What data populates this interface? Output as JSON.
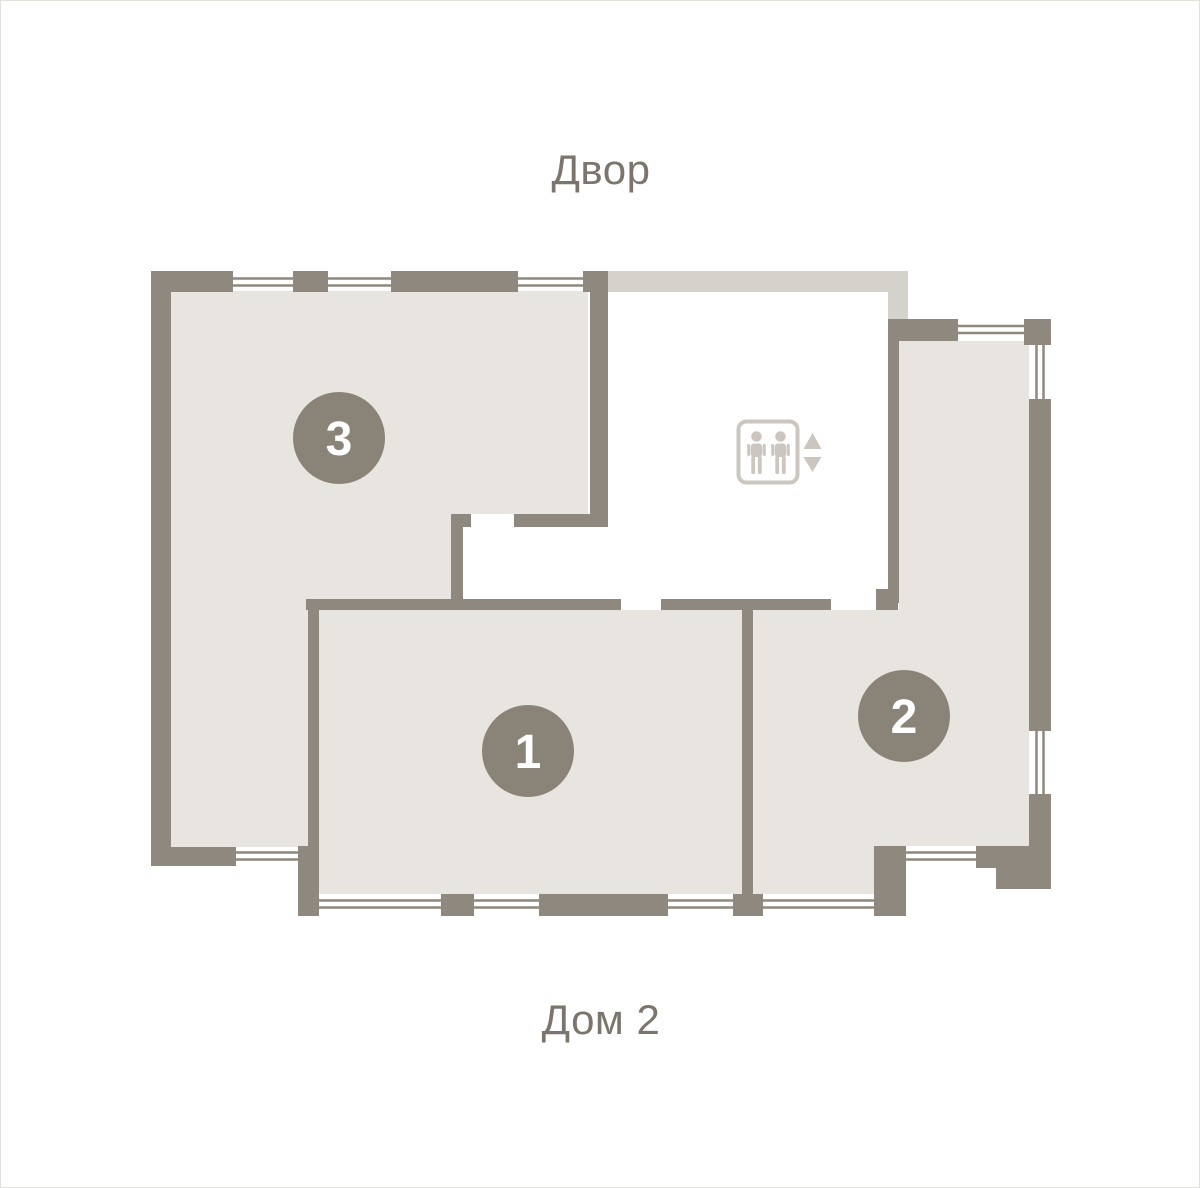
{
  "labels": {
    "courtyard": "Двор",
    "house": "Дом 2"
  },
  "apartments": [
    {
      "number": "1"
    },
    {
      "number": "2"
    },
    {
      "number": "3"
    }
  ],
  "elevator": {
    "icon": "elevator-people-icon",
    "arrows": [
      "up",
      "down"
    ]
  },
  "colors": {
    "background": "#ffffff",
    "wall": "#8e887e",
    "apartment_fill": "#e8e4e0",
    "hall_band": "#d5d1cb",
    "badge": "#8a8478",
    "badge_text": "#ffffff",
    "label_text": "#7b756d",
    "elevator_icon": "#cbc7c0"
  }
}
